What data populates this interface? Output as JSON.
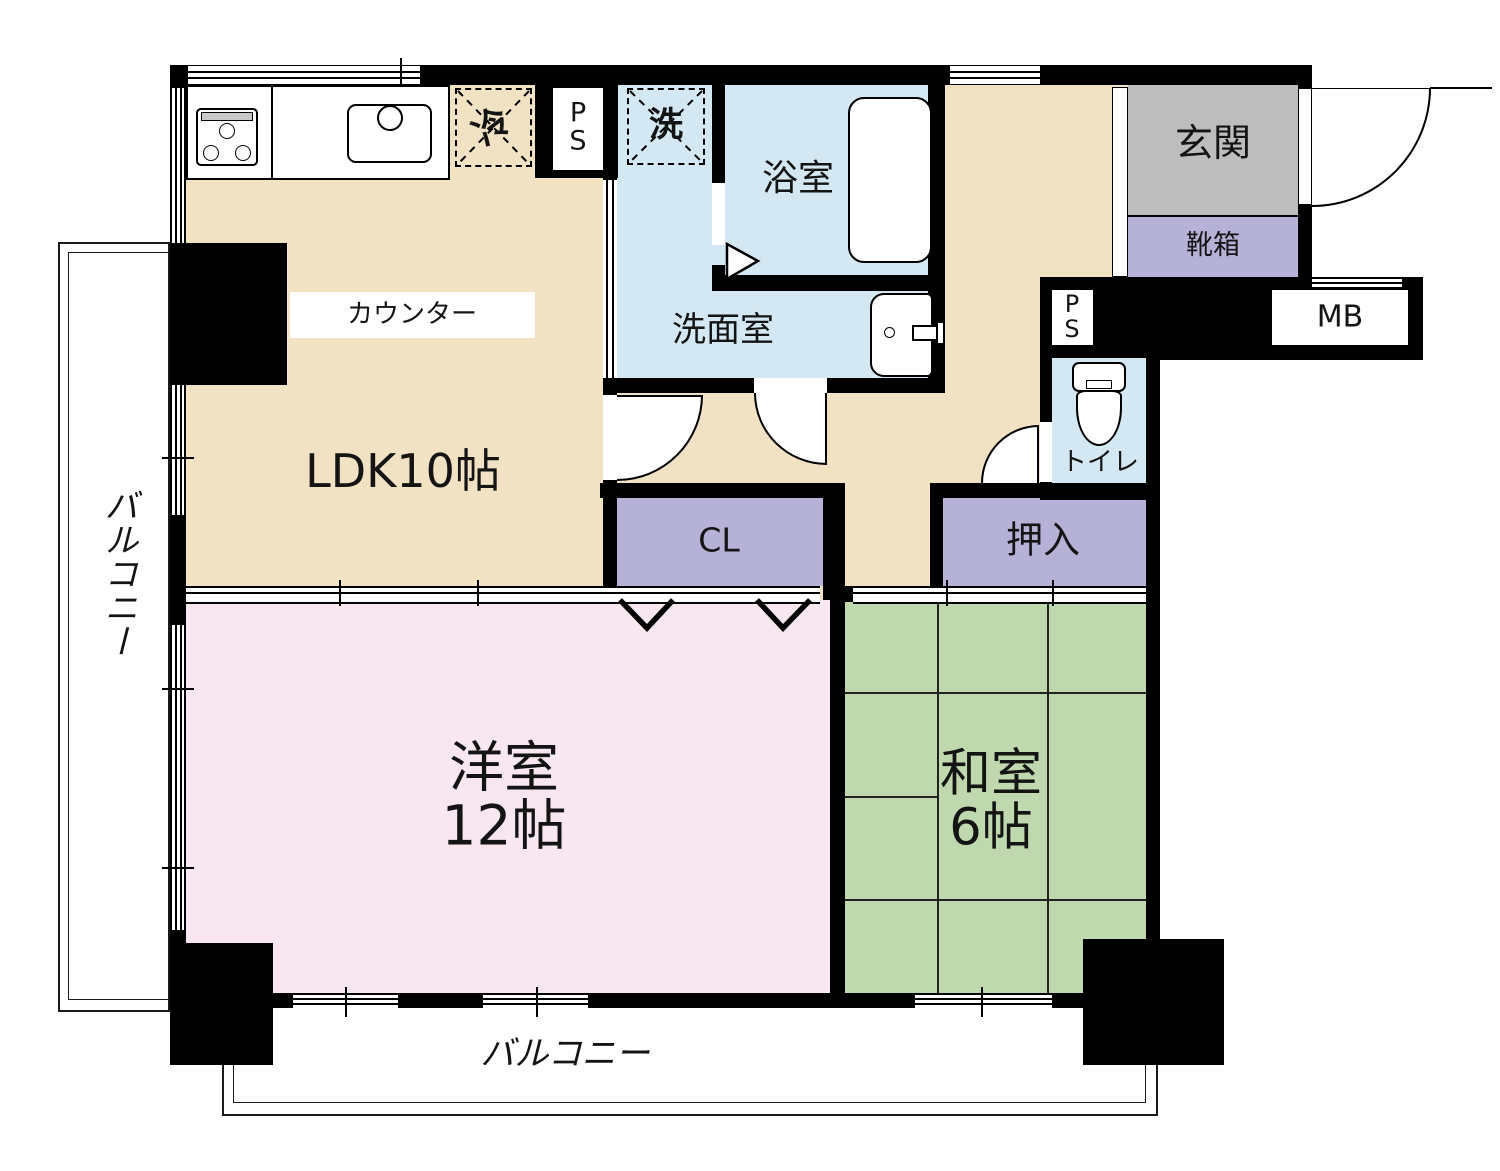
{
  "title": "2LDK apartment floor plan",
  "rooms": {
    "ldk": {
      "label": "LDK10帖"
    },
    "western": {
      "line1": "洋室",
      "line2": "12帖"
    },
    "japanese": {
      "line1": "和室",
      "line2": "6帖"
    },
    "bath": {
      "label": "浴室"
    },
    "washroom": {
      "label": "洗面室"
    },
    "toilet": {
      "label": "トイレ"
    },
    "entrance": {
      "label": "玄関"
    },
    "shoebox": {
      "label": "靴箱"
    },
    "closet": {
      "label": "CL"
    },
    "oshiire": {
      "label": "押入"
    },
    "balcony_left": {
      "label": "バルコニー"
    },
    "balcony_bottom": {
      "label": "バルコニー"
    }
  },
  "fixtures": {
    "counter": {
      "label": "カウンター"
    },
    "fridge": {
      "label": "冷"
    },
    "washer": {
      "label": "洗"
    },
    "ps_top": {
      "line1": "P",
      "line2": "S"
    },
    "ps_side": {
      "line1": "P",
      "line2": "S"
    },
    "meter_box": {
      "label": "MB"
    }
  },
  "colors": {
    "wall": "#000000",
    "ldk_floor": "#F1E2C3",
    "western_floor": "#F8E6F0",
    "japanese_floor": "#BFD8AD",
    "water_floor": "#D4E8F3",
    "closet_floor": "#B6B2D7",
    "entrance_floor": "#BDBDBD"
  }
}
